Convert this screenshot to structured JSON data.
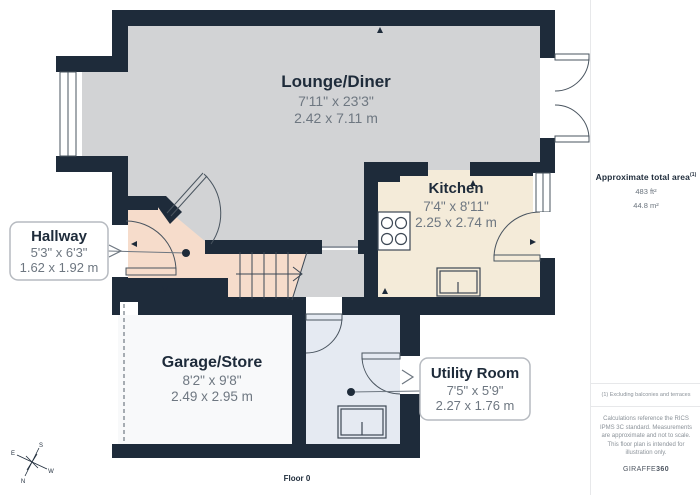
{
  "plan": {
    "floor_label": "Floor 0",
    "rooms": {
      "lounge": {
        "name": "Lounge/Diner",
        "imperial": "7'11\" x 23'3\"",
        "metric": "2.42 x 7.11 m"
      },
      "kitchen": {
        "name": "Kitchen",
        "imperial": "7'4\" x 8'11\"",
        "metric": "2.25 x 2.74 m"
      },
      "hallway": {
        "name": "Hallway",
        "imperial": "5'3\" x 6'3\"",
        "metric": "1.62 x 1.92 m"
      },
      "garage": {
        "name": "Garage/Store",
        "imperial": "8'2\" x 9'8\"",
        "metric": "2.49 x 2.95 m"
      },
      "utility": {
        "name": "Utility Room",
        "imperial": "7'5\" x 5'9\"",
        "metric": "2.27 x 1.76 m"
      }
    },
    "compass": {
      "n": "N",
      "s": "S",
      "e": "E",
      "w": "W"
    }
  },
  "sidebar": {
    "total_area_label": "Approximate total area",
    "total_area_footnote_marker": "(1)",
    "total_area_imperial": "483 ft²",
    "total_area_metric": "44.8 m²",
    "footnote": "(1) Excluding balconies and terraces",
    "disclaimer": "Calculations reference the RICS IPMS 3C standard. Measurements are approximate and not to scale. This floor plan is intended for illustration only.",
    "brand_light": "GIRAFFE",
    "brand_bold": "360"
  },
  "colors": {
    "wall": "#1e2b3a",
    "lounge_fill": "#d2d3d5",
    "kitchen_fill": "#f4ebd9",
    "hallway_fill": "#f6dccb",
    "garage_fill": "#f8f9fa",
    "utility_fill": "#e5eaf2"
  }
}
